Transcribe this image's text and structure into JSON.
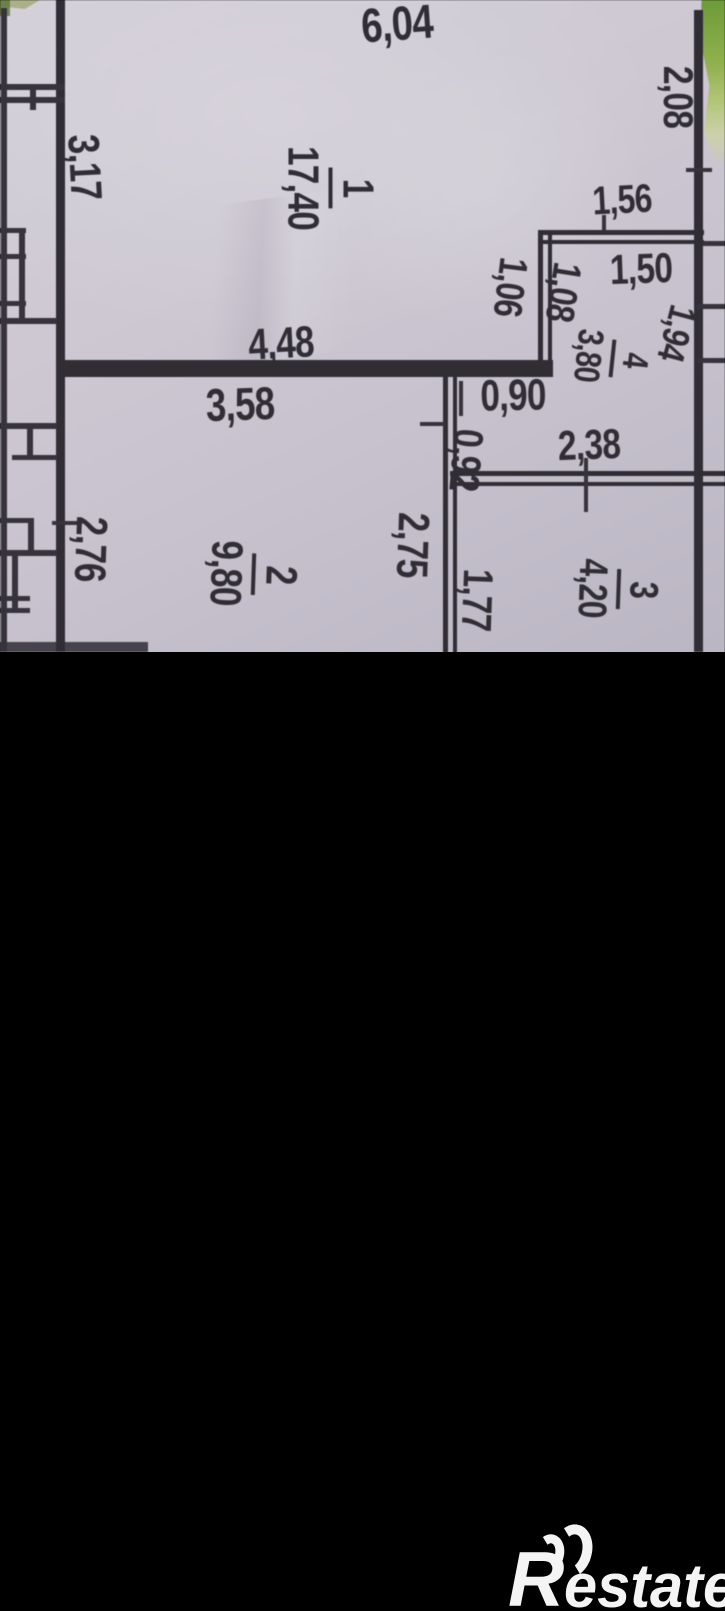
{
  "floor_plan": {
    "rooms": [
      {
        "number": "1",
        "area": "17,40"
      },
      {
        "number": "2",
        "area": "9,80"
      },
      {
        "number": "3",
        "area": "4,20"
      },
      {
        "number": "4",
        "area": "3,80"
      }
    ],
    "dimensions": [
      {
        "id": "d604",
        "text": "6,04"
      },
      {
        "id": "d208",
        "text": "2,08"
      },
      {
        "id": "d317",
        "text": "3,17"
      },
      {
        "id": "d156",
        "text": "1,56"
      },
      {
        "id": "d150",
        "text": "1,50"
      },
      {
        "id": "d106",
        "text": "1,06"
      },
      {
        "id": "d108",
        "text": "1,08"
      },
      {
        "id": "d194",
        "text": "1,94"
      },
      {
        "id": "d448",
        "text": "4,48"
      },
      {
        "id": "d358",
        "text": "3,58"
      },
      {
        "id": "d090",
        "text": "0,90"
      },
      {
        "id": "d092",
        "text": "0,92"
      },
      {
        "id": "d238",
        "text": "2,38"
      },
      {
        "id": "d275",
        "text": "2,75"
      },
      {
        "id": "d177",
        "text": "1,77"
      },
      {
        "id": "d276",
        "text": "2,76"
      }
    ],
    "colors": {
      "paper": "#cdc8d3",
      "ink": "#2e2a33",
      "background": "#000000",
      "foliage": "#8fb24b",
      "watermark": "#f4f4f4"
    }
  },
  "watermark": {
    "brand_initial": "R",
    "brand_rest": "estate"
  }
}
